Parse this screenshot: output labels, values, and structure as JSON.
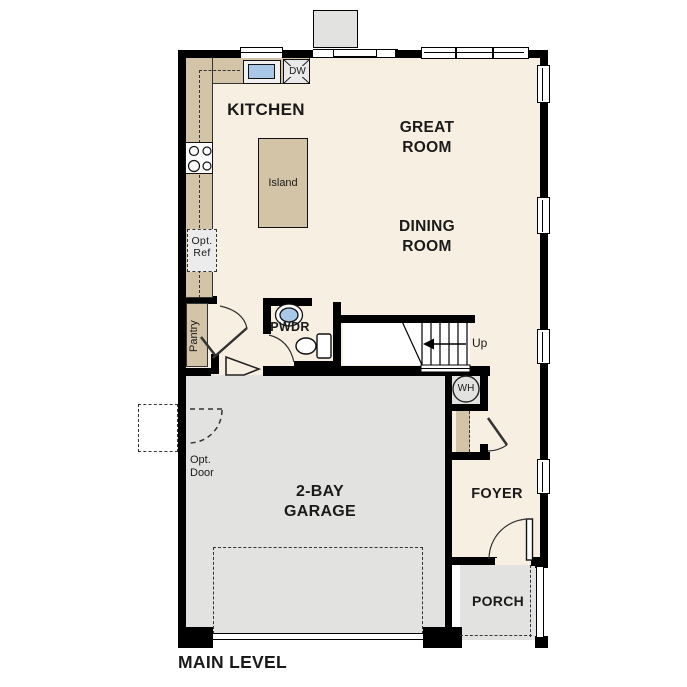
{
  "plan_title": "MAIN LEVEL",
  "rooms": {
    "kitchen": {
      "label": "KITCHEN"
    },
    "great_room": {
      "line1": "GREAT",
      "line2": "ROOM"
    },
    "dining_room": {
      "line1": "DINING",
      "line2": "ROOM"
    },
    "garage": {
      "line1": "2-BAY",
      "line2": "GARAGE"
    },
    "foyer": {
      "label": "FOYER"
    },
    "porch": {
      "label": "PORCH"
    },
    "powder_room": {
      "label": "PWDR"
    },
    "pantry": {
      "label": "Pantry"
    },
    "stairs": {
      "direction_label": "Up"
    }
  },
  "fixtures": {
    "island": {
      "label": "Island"
    },
    "dishwasher": {
      "label": "DW"
    },
    "water_heater": {
      "label": "WH"
    },
    "optional_refrigerator": {
      "line1": "Opt.",
      "line2": "Ref"
    },
    "optional_door": {
      "line1": "Opt.",
      "line2": "Door"
    }
  },
  "colors": {
    "wall": "#000000",
    "interior": "#f7efe1",
    "counter_tan": "#d3c3a7",
    "garage_grey": "#e2e2e0",
    "sink_blue": "#a9c7e7"
  }
}
